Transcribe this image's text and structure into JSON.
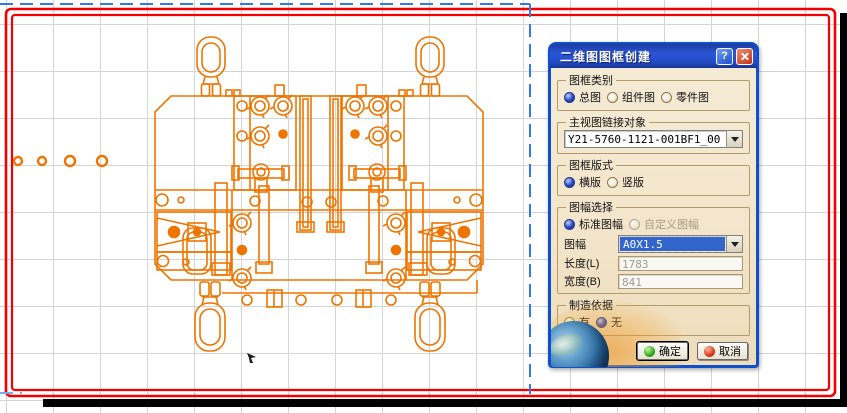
{
  "canvas": {
    "grid_color": "#d4d4d4",
    "sheet_border_color": "#ff0000",
    "shadow_color": "#000000",
    "frame_preview_color": "#2f7bea",
    "drawing_color": "#ee7400",
    "drawing_description": "fixture assembly front view with four lifting eyebolts"
  },
  "dialog": {
    "title": "二维图图框创建",
    "help": "?",
    "frame_type": {
      "label": "图框类别",
      "options": [
        {
          "label": "总图",
          "selected": true
        },
        {
          "label": "组件图",
          "selected": false
        },
        {
          "label": "零件图",
          "selected": false
        }
      ]
    },
    "main_view_link": {
      "label": "主视图链接对象",
      "value": "Y21-5760-1121-001BF1_00"
    },
    "frame_layout": {
      "label": "图框版式",
      "options": [
        {
          "label": "横版",
          "selected": true
        },
        {
          "label": "竖版",
          "selected": false
        }
      ]
    },
    "sheet_selection": {
      "label": "图幅选择",
      "options": [
        {
          "label": "标准图幅",
          "selected": true,
          "disabled": false
        },
        {
          "label": "自定义图幅",
          "selected": false,
          "disabled": true
        }
      ],
      "sheet_label": "图幅",
      "sheet_value": "A0X1.5",
      "length_label": "长度(L)",
      "length_value": "1783",
      "width_label": "宽度(B)",
      "width_value": "841"
    },
    "manufacturing_basis": {
      "label": "制造依据",
      "options": [
        {
          "label": "有",
          "selected": false
        },
        {
          "label": "无",
          "selected": true
        }
      ]
    },
    "buttons": {
      "ok": "确定",
      "cancel": "取消"
    }
  }
}
